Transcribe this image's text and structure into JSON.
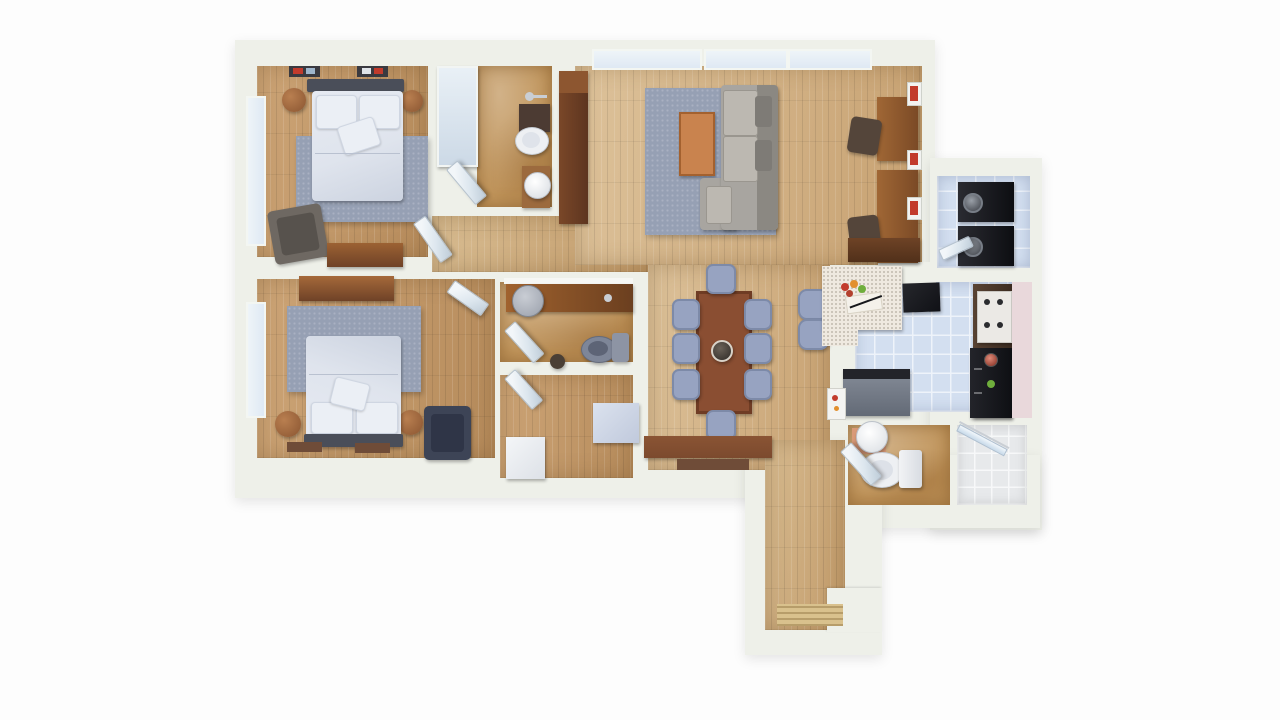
{
  "meta": {
    "description": "3D top-down rendered floor plan of a two-bedroom apartment",
    "view": "overhead dollhouse render",
    "visible_text": ""
  },
  "palette": {
    "bg": "#fdfdfd",
    "wall": "#eef0e9",
    "bathTan": "#c0945a",
    "tileBlue": "#d3dff0",
    "tileLine": "#eef3fa",
    "showerTile": "#e7e9eb",
    "rug": "#96a0b4",
    "bedLinen": "#dfe4ed",
    "pillow": "#ebeff5",
    "headboard": "#4a4e59",
    "furnBrown": "#94603a",
    "furnBrownDark": "#6f4227",
    "sideboard": "#7c4a2e",
    "tableBrown": "#8a4e32",
    "coffeeTable": "#c9834e",
    "sofaBody": "#a8a5a0",
    "sofaBack": "#8b8882",
    "sofaSeat": "#bcb8b1",
    "chairNavy": "#3d4456",
    "chairBlue": "#97a3c1",
    "applianceBlack": "#16171b",
    "counterSpeckle": "#efe9e0",
    "counterDark": "#4b382b",
    "stoveWhite": "#ebe9e5",
    "islandGray": "#757c88",
    "pinkWall": "#e9d8db",
    "glass": "#dfe9f4",
    "door": "#dce6ee",
    "matTan": "#d9c18d",
    "matBrown": "#6f4c38",
    "accentRed": "#c23b2c",
    "accentOrange": "#e2902f",
    "accentGreen": "#6fae3c",
    "sinkWhite": "#eef0f3",
    "toiletGray": "#7e8698",
    "chrome": "#c9ced4"
  },
  "rooms": [
    {
      "id": "bedroom-1",
      "floor": "wood",
      "furniture": [
        "double-bed",
        "headboard",
        "area-rug",
        "nightstand-left",
        "nightstand-right",
        "armchair",
        "dresser",
        "wall-art-frames",
        "window"
      ]
    },
    {
      "id": "bedroom-2",
      "floor": "wood",
      "furniture": [
        "double-bed",
        "headboard",
        "area-rug",
        "nightstand-left",
        "nightstand-right",
        "navy-armchair",
        "long-dresser",
        "bedside-mats",
        "window"
      ]
    },
    {
      "id": "bathroom-1",
      "floor": "stone-tan",
      "furniture": [
        "toilet",
        "vanity",
        "faucet",
        "round-sink-cabinet",
        "door"
      ]
    },
    {
      "id": "bathroom-2",
      "floor": "stone-tan",
      "furniture": [
        "wood-vanity",
        "round-gray-sink",
        "gray-toilet",
        "faucet",
        "stool",
        "door"
      ]
    },
    {
      "id": "storage-room",
      "floor": "wood",
      "furniture": [
        "white-hamper",
        "blue-storage-box",
        "door"
      ]
    },
    {
      "id": "closet",
      "floor": "none",
      "furniture": [
        "sliding-panel"
      ]
    },
    {
      "id": "living-room",
      "floor": "wood",
      "furniture": [
        "sectional-sofa",
        "chaise",
        "coffee-table",
        "area-rug",
        "tall-wardrobe",
        "desk-upper",
        "desk-lower",
        "desk-chairs",
        "wall-mounted-red-units",
        "window-band"
      ]
    },
    {
      "id": "dining-area",
      "floor": "wood",
      "furniture": [
        "dining-table",
        "eight-blue-chairs",
        "centerpiece-bowl",
        "sideboard",
        "door-mat",
        "two-bar-stools"
      ]
    },
    {
      "id": "kitchen",
      "floor": "tile-blue",
      "furniture": [
        "speckled-peninsula-counter",
        "fruit-and-cutting-board",
        "wall-tv",
        "dark-counter",
        "white-cooktop",
        "black-oven",
        "gray-island",
        "wall-art",
        "upper-cabinet"
      ]
    },
    {
      "id": "laundry-closet",
      "floor": "tile-blue",
      "furniture": [
        "stacked-washer",
        "stacked-dryer",
        "door"
      ]
    },
    {
      "id": "bathroom-3",
      "floor": "stone-tan",
      "furniture": [
        "pedestal-sink",
        "toilet",
        "bath-mat",
        "door"
      ]
    },
    {
      "id": "shower-room",
      "floor": "tile-white",
      "furniture": [
        "glass-shower-door"
      ]
    },
    {
      "id": "entry-hall",
      "floor": "wood",
      "furniture": [
        "entry-door-mat"
      ]
    }
  ]
}
